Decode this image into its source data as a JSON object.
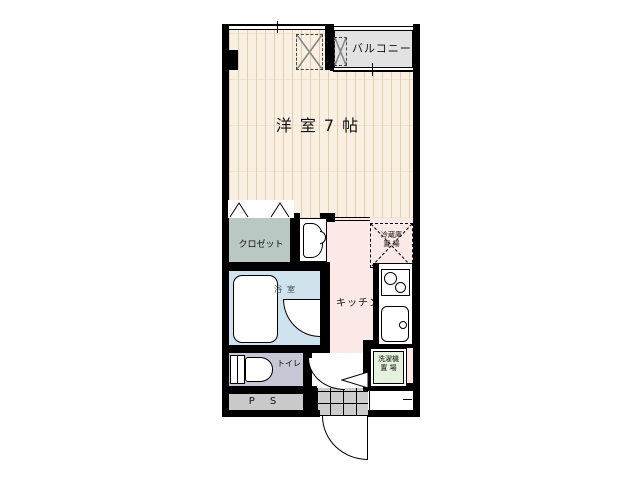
{
  "plan": {
    "balcony_label": "バルコニー",
    "room_label": "洋室7帖",
    "closet_label": "クロゼット",
    "bath_label": "浴室",
    "kitchen_label": "キッチン",
    "toilet_label": "トイレ",
    "ps_label": "P S",
    "fridge_label_1": "冷蔵庫",
    "fridge_label_2": "置 場",
    "washer_label_1": "洗濯機",
    "washer_label_2": "置 場"
  },
  "colors": {
    "wood_floor": "#f9f0e2",
    "wood_stripe": "#dfcfb4",
    "balcony": "#e2e2e2",
    "closet": "#b9c8c3",
    "bathroom": "#cfe3ef",
    "kitchen": "#fbe9e7",
    "toilet": "#c6c6d4",
    "pipe_space": "#c9c9c9",
    "genkan_tile": "#cccccc",
    "washer_space": "#e4f1dc",
    "wall": "#000000"
  }
}
